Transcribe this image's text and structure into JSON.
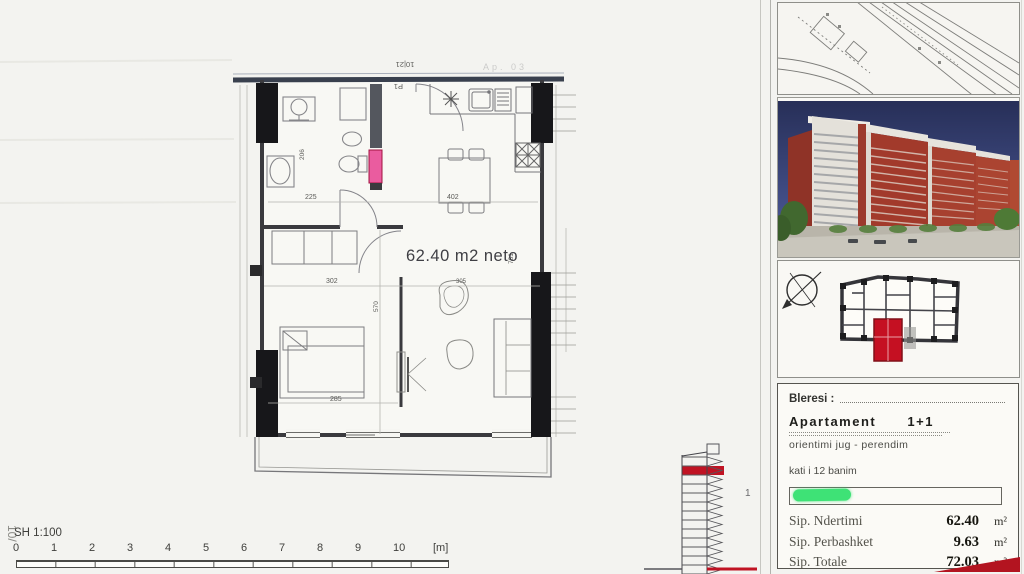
{
  "plan": {
    "area_label": "62.40 m2 neto",
    "door_label": "P1",
    "door_dim": "10|21",
    "faint_label": "Ap. 03",
    "dims": {
      "bath": "206",
      "hall": "225",
      "kitchen_table": "402",
      "bedroom_w": "302",
      "chair": "305",
      "bedroom_h": "570",
      "bed": "285",
      "living_h": "781"
    }
  },
  "section": {
    "floor_marker": "1"
  },
  "scale": {
    "label": "SH 1:100",
    "edge_note": "10/",
    "ticks": [
      "0",
      "1",
      "2",
      "3",
      "4",
      "5",
      "6",
      "7",
      "8",
      "9",
      "10"
    ],
    "unit": "[m]"
  },
  "info": {
    "buyer_label": "Bleresi :",
    "apartment_label": "Apartament",
    "apartment_type": "1+1",
    "orientation": "orientimi jug - perendim",
    "floor_note": "kati i 12 banim",
    "rows": [
      {
        "label": "Sip. Ndertimi",
        "value": "62.40",
        "unit": "m²"
      },
      {
        "label": "Sip. Perbashket",
        "value": "9.63",
        "unit": "m²"
      },
      {
        "label": "Sip. Totale",
        "value": "72.03",
        "unit": "m²"
      }
    ]
  },
  "colors": {
    "accent_red": "#c0121f",
    "highlight_green": "#3ee276",
    "shaft_pink": "#ea5c9f",
    "sky_blue": "#2e3963",
    "brick_red": "#a23a2b"
  }
}
